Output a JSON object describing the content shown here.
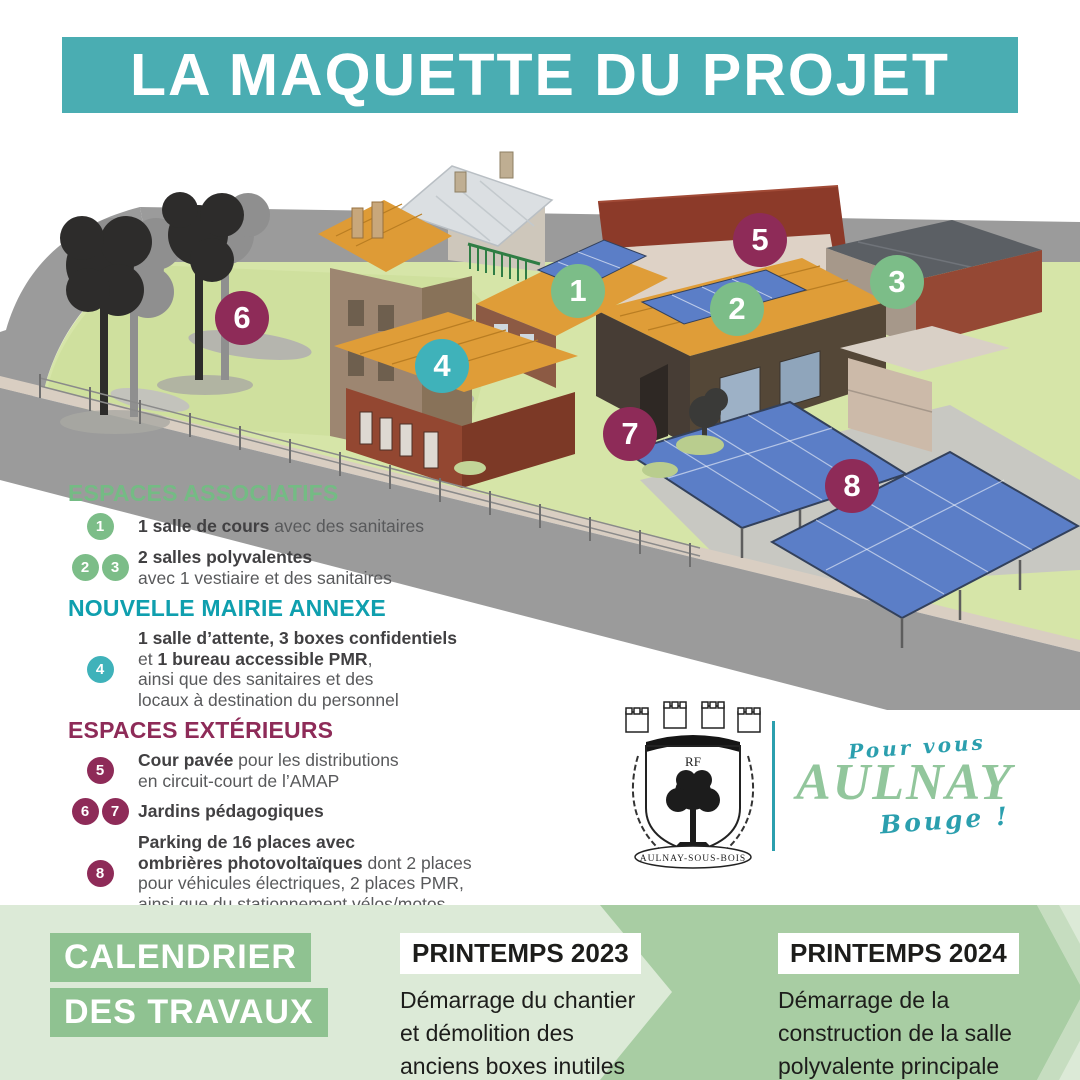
{
  "title": "LA MAQUETTE DU PROJET",
  "colors": {
    "banner_teal": "#4aadb2",
    "green": "#7cbd88",
    "teal": "#3fb2ba",
    "maroon": "#8e2b58",
    "heading_green": "#74bb84",
    "heading_teal": "#0f9fae",
    "heading_maroon": "#8e2b58",
    "band_base": "#dcead7",
    "band_medium": "#a8cda3",
    "band_light_stripe": "#c6ddc0",
    "cal_box_green": "#8fc291"
  },
  "legend": {
    "sections": [
      {
        "heading": "ESPACES ASSOCIATIFS",
        "heading_color": "#74bb84",
        "badge_color": "#7cbd88",
        "items": [
          {
            "badges": [
              "1"
            ],
            "lines": [
              [
                {
                  "t": "1 salle de cours",
                  "b": true
                },
                {
                  "t": " avec des sanitaires",
                  "b": false
                }
              ]
            ]
          },
          {
            "badges": [
              "2",
              "3"
            ],
            "lines": [
              [
                {
                  "t": "2 salles polyvalentes",
                  "b": true
                }
              ],
              [
                {
                  "t": "avec 1 vestiaire et des sanitaires",
                  "b": false
                }
              ]
            ]
          }
        ]
      },
      {
        "heading": "NOUVELLE MAIRIE ANNEXE",
        "heading_color": "#0f9fae",
        "badge_color": "#3fb2ba",
        "items": [
          {
            "badges": [
              "4"
            ],
            "lines": [
              [
                {
                  "t": "1 salle d’attente, 3 boxes confidentiels",
                  "b": true
                }
              ],
              [
                {
                  "t": "et ",
                  "b": false
                },
                {
                  "t": "1 bureau accessible PMR",
                  "b": true
                },
                {
                  "t": ",",
                  "b": false
                }
              ],
              [
                {
                  "t": "ainsi que des sanitaires et des",
                  "b": false
                }
              ],
              [
                {
                  "t": "locaux à destination du personnel",
                  "b": false
                }
              ]
            ]
          }
        ]
      },
      {
        "heading": "ESPACES EXTÉRIEURS",
        "heading_color": "#8e2b58",
        "badge_color": "#8e2b58",
        "items": [
          {
            "badges": [
              "5"
            ],
            "lines": [
              [
                {
                  "t": "Cour pavée",
                  "b": true
                },
                {
                  "t": " pour les distributions",
                  "b": false
                }
              ],
              [
                {
                  "t": "en circuit-court de l’AMAP",
                  "b": false
                }
              ]
            ]
          },
          {
            "badges": [
              "6",
              "7"
            ],
            "lines": [
              [
                {
                  "t": "Jardins pédagogiques",
                  "b": true
                }
              ]
            ]
          },
          {
            "badges": [
              "8"
            ],
            "lines": [
              [
                {
                  "t": "Parking de 16 places avec",
                  "b": true
                }
              ],
              [
                {
                  "t": "ombrières photovoltaïques",
                  "b": true
                },
                {
                  "t": " dont 2 places",
                  "b": false
                }
              ],
              [
                {
                  "t": "pour véhicules électriques, 2 places PMR,",
                  "b": false
                }
              ],
              [
                {
                  "t": "ainsi que du stationnement vélos/motos",
                  "b": false
                }
              ]
            ]
          }
        ]
      }
    ]
  },
  "model": {
    "badges": [
      {
        "n": "1",
        "x": 578,
        "y": 291,
        "color": "#7cbd88"
      },
      {
        "n": "2",
        "x": 737,
        "y": 309,
        "color": "#7cbd88"
      },
      {
        "n": "3",
        "x": 897,
        "y": 282,
        "color": "#7cbd88"
      },
      {
        "n": "4",
        "x": 442,
        "y": 366,
        "color": "#3fb2ba"
      },
      {
        "n": "5",
        "x": 760,
        "y": 240,
        "color": "#8e2b58"
      },
      {
        "n": "6",
        "x": 242,
        "y": 318,
        "color": "#8e2b58"
      },
      {
        "n": "7",
        "x": 630,
        "y": 434,
        "color": "#8e2b58"
      },
      {
        "n": "8",
        "x": 852,
        "y": 486,
        "color": "#8e2b58"
      }
    ]
  },
  "logo": {
    "shield_initials": "RF",
    "city_banner": "AULNAY-SOUS-BOIS",
    "tagline_top": "Pour vous",
    "tagline_name": "AULNAY",
    "tagline_excl": "Bouge !"
  },
  "calendar": {
    "title_line1": "CALENDRIER",
    "title_line2": "DES TRAVAUX",
    "milestones": [
      {
        "period": "PRINTEMPS 2023",
        "lines": [
          "Démarrage du chantier",
          "et démolition des",
          "anciens boxes inutiles"
        ]
      },
      {
        "period": "PRINTEMPS 2024",
        "lines": [
          "Démarrage de la",
          "construction de la salle",
          "polyvalente principale"
        ]
      }
    ]
  }
}
